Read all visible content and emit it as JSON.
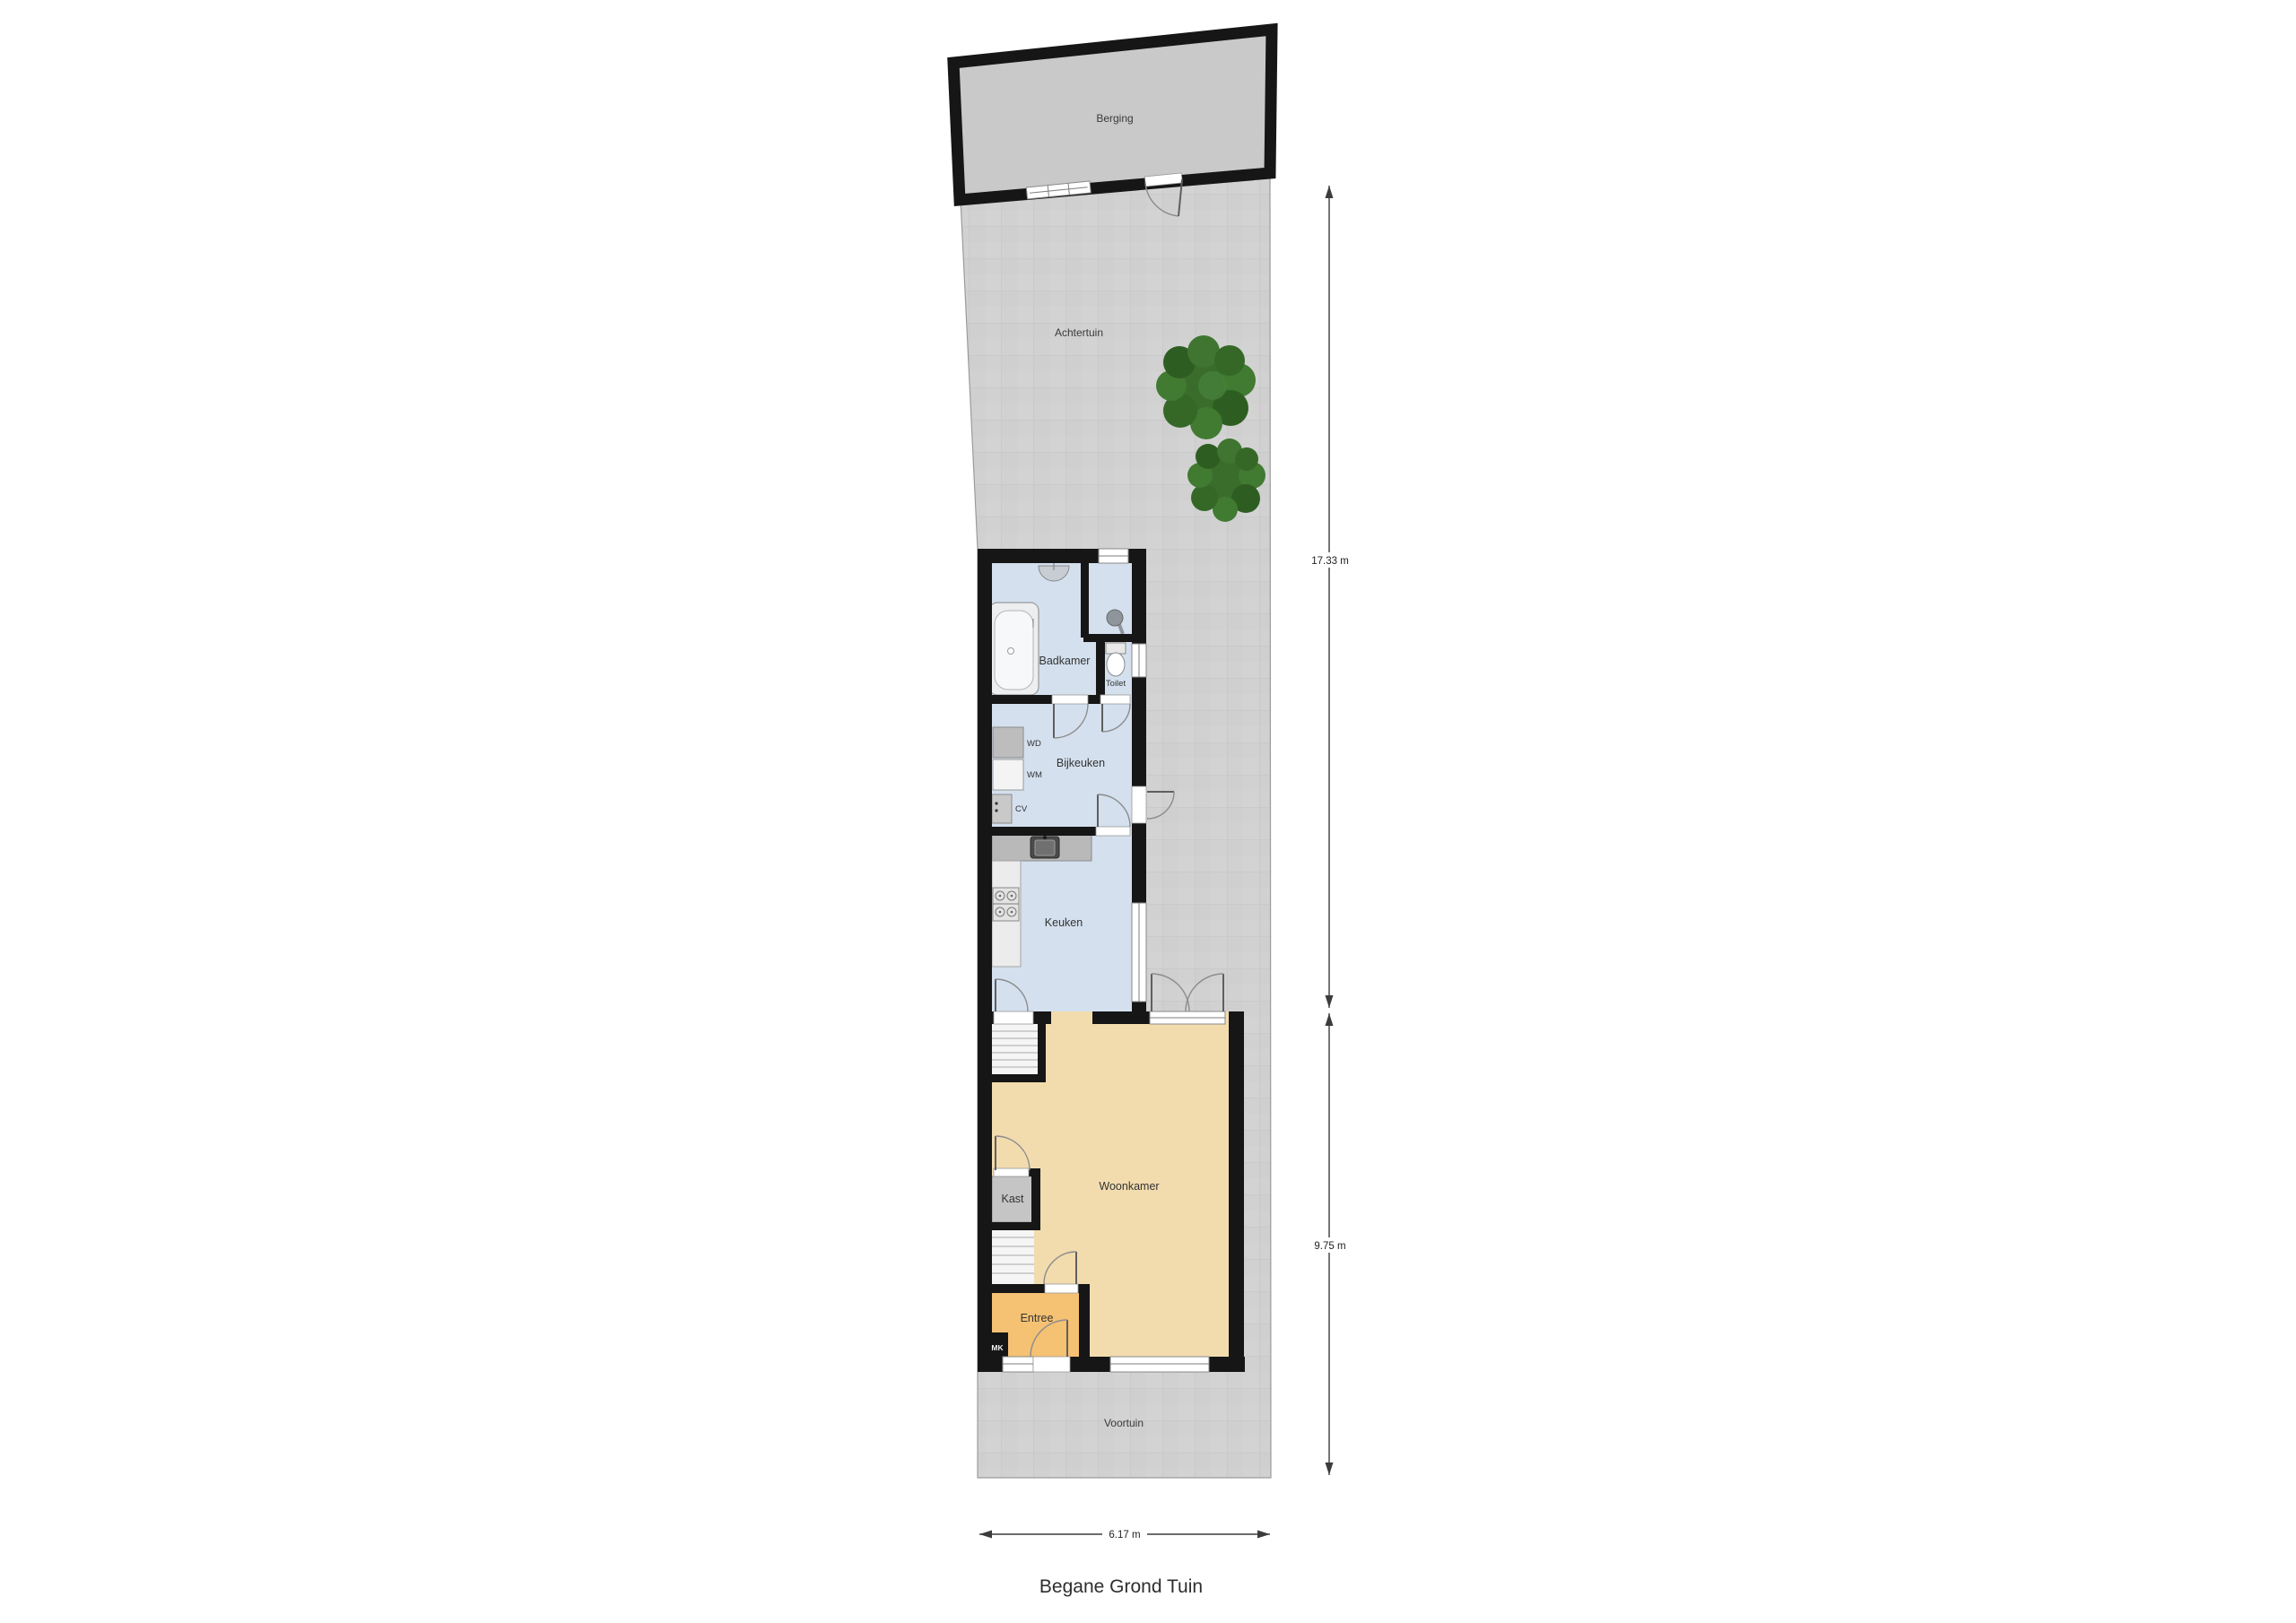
{
  "title": "Begane Grond Tuin",
  "rooms": {
    "berging": "Berging",
    "achtertuin": "Achtertuin",
    "badkamer": "Badkamer",
    "toilet": "Toilet",
    "bijkeuken": "Bijkeuken",
    "keuken": "Keuken",
    "woonkamer": "Woonkamer",
    "kast": "Kast",
    "entree": "Entree",
    "voortuin": "Voortuin"
  },
  "appliances": {
    "wd": "WD",
    "wm": "WM",
    "cv": "CV",
    "mk": "MK"
  },
  "dimensions": {
    "vertical_top": "17.33 m",
    "vertical_bottom": "9.75 m",
    "horizontal": "6.17 m"
  },
  "colors": {
    "wall": "#161616",
    "garden": "#d1d1d1",
    "shed": "#c9c9c9",
    "wet": "#d4e0ee",
    "living": "#f2dcae",
    "entry": "#f5c173",
    "closet": "#c5c5c5",
    "counter": "#b9b9b9",
    "tree": "#3a6d2c"
  }
}
